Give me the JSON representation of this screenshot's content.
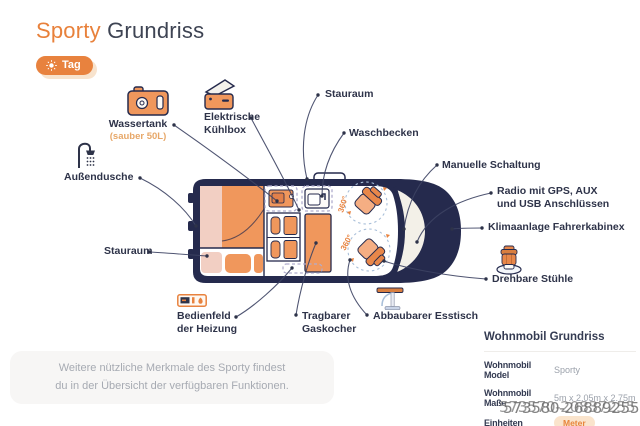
{
  "header": {
    "title_accent": "Sporty",
    "title_rest": " Grundriss",
    "badge_label": "Tag"
  },
  "diagram": {
    "rotation_label": "360°"
  },
  "features": {
    "wassertank": {
      "label": "Wassertank",
      "sub": "(sauber 50L)"
    },
    "kuehlbox": {
      "line1": "Elektrische",
      "line2": "Kühlbox"
    },
    "stauraum_top": {
      "label": "Stauraum"
    },
    "waschbecken": {
      "label": "Waschbecken"
    },
    "manuelle_schaltung": {
      "label": "Manuelle Schaltung"
    },
    "radio": {
      "line1": "Radio mit GPS, AUX",
      "line2": "und USB Anschlüssen"
    },
    "klimaanlage": {
      "label": "Klimaanlage Fahrerkabinex"
    },
    "drehbare_stuehle": {
      "label": "Drehbare Stühle"
    },
    "esstisch": {
      "label": "Abbaubarer Esstisch"
    },
    "gaskocher": {
      "line1": "Tragbarer",
      "line2": "Gaskocher"
    },
    "bedienfeld": {
      "line1": "Bedienfeld",
      "line2": "der Heizung"
    },
    "stauraum_left": {
      "label": "Stauraum"
    },
    "aussendusche": {
      "label": "Außendusche"
    }
  },
  "note": {
    "line1": "Weitere nützliche Merkmale des Sporty findest",
    "line2": "du in der Übersicht der verfügbaren Funktionen."
  },
  "info_panel": {
    "title": "Wohnmobil Grundriss",
    "rows": [
      {
        "label": "Wohnmobil Model",
        "value": "Sporty"
      },
      {
        "label": "Wohnmobil Maße",
        "value": "5m x 2.05m x 2.75m"
      },
      {
        "label": "Einheiten",
        "value": "Meter"
      }
    ],
    "watermark_back": "573570-20837255",
    "watermark_front": "573580-26889255"
  },
  "colors": {
    "accent": "#E8823E",
    "furniture": "#F0975C",
    "van_body": "#252A4D"
  }
}
